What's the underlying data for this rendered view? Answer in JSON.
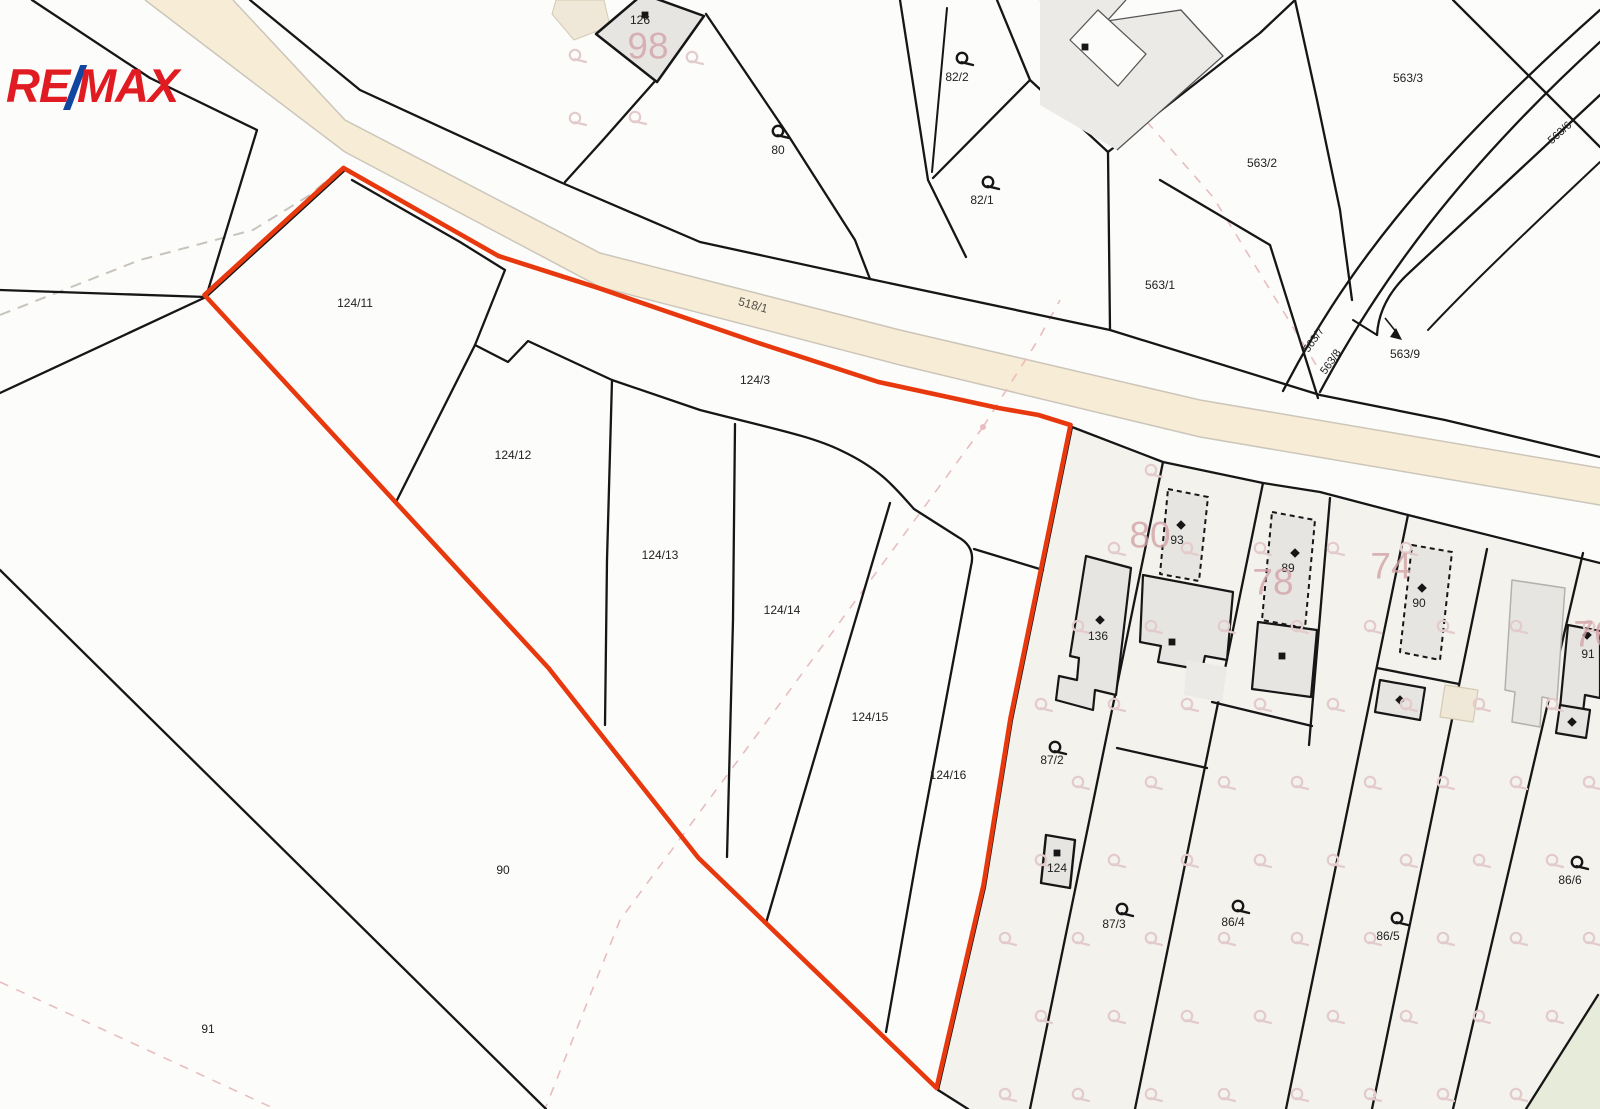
{
  "logo": {
    "re": "RE",
    "slash": "/",
    "max": "MAX"
  },
  "colors": {
    "bg": "#fcfcfb",
    "line": "#161616",
    "red": "#e8380d",
    "red_dark": "#c42d08",
    "road_fill": "#f7ecd6",
    "road_edge": "#ccc6ba",
    "ivory": "#f3f2ec",
    "green": "#e6ecd9",
    "building": "#e7e5e2",
    "building_lt": "#eceae6",
    "tan": "#efe8d9",
    "tan_edge": "#d5cab1",
    "gray_edge": "#b3b1ac",
    "label": "#222222",
    "road_label": "#55504a",
    "pink_label": "#d2a3a6",
    "pink_line": "#e9bdbd",
    "pink_sym": "#e3cbcb",
    "gray_dash": "#c9c4bb",
    "thin_edge": "#555555"
  },
  "map": {
    "road": {
      "fill": "M233,0 L345,120 L600,253 L900,330 L1200,400 L1600,468 L1600,505 L1200,437 L900,365 L600,287 L345,152 L250,80 L145,0 Z",
      "edges": [
        "M233,0 L345,120 L600,253 L900,330 L1200,400 L1600,468",
        "M145,0 L250,80 L345,152 L600,287 L900,365 L1200,437 L1600,505"
      ]
    },
    "regions": [
      {
        "d": "M1072,427 L1163,462 L1263,483 L1320,492 L1400,513 L1600,563 L1600,1109 L968,1109 L938,1090 L985,887 L1012,720 Z",
        "fill": "ivory"
      },
      {
        "d": "M1598,995 L1600,993 L1600,1109 L1526,1109 Z",
        "fill": "green"
      }
    ],
    "gray_dashed": [
      "M0,315 L140,260 L253,230 L310,195 L345,165"
    ],
    "pink_dashed": [
      "M983,427 L1038,340 L1060,300",
      "M983,427 L790,690 L620,920 L545,1109",
      "M0,982 L273,1108",
      "M1040,0 L1213,197 L1318,368"
    ],
    "pink_dot": [
      983,
      427
    ],
    "lines": [
      {
        "d": "M32,0 L150,78 L257,130 L206,297"
      },
      {
        "d": "M0,290 L206,297"
      },
      {
        "d": "M206,297 L0,393"
      },
      {
        "d": "M250,0 L360,90 L560,182 L700,242 L870,279 L1110,330 L1320,395 L1445,420 L1600,457"
      },
      {
        "d": "M656,80 L603,140 L565,182"
      },
      {
        "d": "M706,14 L788,135 L855,240 L870,279"
      },
      {
        "d": "M900,0 L928,180 L966,257"
      },
      {
        "d": "M947,8 L932,172",
        "w": 2
      },
      {
        "d": "M997,0 L1030,80 L933,178"
      },
      {
        "d": "M1030,80 L1108,152 L1110,330"
      },
      {
        "d": "M1108,152 L1260,33 L1295,0"
      },
      {
        "d": "M1295,0 L1317,100 L1340,210 L1352,300"
      },
      {
        "d": "M1160,180 L1270,245 L1318,398"
      },
      {
        "d": "M1453,0 L1600,147"
      },
      {
        "d": "M1283,391 C1340,280 1420,170 1600,10"
      },
      {
        "d": "M1320,392 C1380,280 1460,170 1600,42"
      },
      {
        "d": "M1377,335 Q1379,300 1410,272 C1460,225 1530,160 1600,95"
      },
      {
        "d": "M1600,162 C1530,228 1470,285 1428,330",
        "w": 2
      },
      {
        "d": "M1353,320 L1377,335",
        "w": 2
      },
      {
        "d": "M1072,427 L1163,462 L1263,483 L1320,492 L1400,513 L1600,563"
      },
      {
        "d": "M352,180 L460,242 L505,270 L475,345 L396,502"
      },
      {
        "d": "M475,345 L508,362 L528,341 L612,380 L700,410 C770,428 812,436 842,451 C882,470 896,489 914,509 L958,537 Q976,547 971,566 L918,850 L886,1032"
      },
      {
        "d": "M974,549 L1043,570"
      },
      {
        "d": "M612,380 L607,560 L605,725"
      },
      {
        "d": "M735,424 L733,620 L727,857"
      },
      {
        "d": "M890,503 L800,807 L766,923"
      },
      {
        "d": "M1163,462 L1030,1109"
      },
      {
        "d": "M1263,483 L1135,1109"
      },
      {
        "d": "M1330,498 L1309,745"
      },
      {
        "d": "M1408,515 L1286,1109"
      },
      {
        "d": "M1487,549 L1372,1109"
      },
      {
        "d": "M1583,553 L1453,1109"
      },
      {
        "d": "M1117,748 L1207,768"
      },
      {
        "d": "M1212,702 L1312,726"
      },
      {
        "d": "M1377,668 L1459,684"
      },
      {
        "d": "M1598,995 L1526,1109"
      },
      {
        "d": "M938,1090 L968,1109"
      },
      {
        "d": "M0,570 L546,1109"
      }
    ],
    "red_underlay": [
      "M206,297 L345,170",
      "M206,297 L550,670 L700,860 L938,1090",
      "M938,1090 L985,887 L1012,720 L1072,427"
    ],
    "red_outline": "M206,297 L345,170 L500,258 L600,290 L760,345 L880,384 L1000,410 L1040,417 L1072,427 L1012,720 L985,887 L938,1090 L700,860 L550,670 Z",
    "buildings": [
      {
        "pts": "556,0 604,0 610,26 574,40 552,14",
        "fill": "tan",
        "stroke": "tan_edge",
        "w": 1
      },
      {
        "pts": "1040,0 1126,0 1107,21 1181,10 1223,56 1117,150 1040,105",
        "fill": "building_lt",
        "stroke": "none",
        "w": 0
      },
      {
        "pts": "596,34 643,-6 704,16 657,82",
        "fill": "building",
        "stroke": "line",
        "w": 2.5
      },
      {
        "pts": "1086,556 1131,568 1116,695 1095,690 1093,710 1056,700 1059,676 1077,680 1079,658 1070,656",
        "fill": "building",
        "stroke": "line",
        "w": 2.2
      },
      {
        "pts": "1168,489 1208,497 1199,581 1160,574",
        "fill": "building",
        "stroke": "line",
        "w": 2,
        "dash": "5,4"
      },
      {
        "pts": "1143,575 1233,592 1227,660 1205,656 1202,670 1158,662 1161,646 1140,642",
        "fill": "building",
        "stroke": "line",
        "w": 2.2
      },
      {
        "pts": "1187,660 1227,667 1222,702 1184,695",
        "fill": "building_lt",
        "stroke": "none",
        "w": 0
      },
      {
        "pts": "1272,512 1315,520 1305,628 1262,620",
        "fill": "building",
        "stroke": "line",
        "w": 2,
        "dash": "5,4"
      },
      {
        "pts": "1258,622 1317,630 1311,697 1252,689",
        "fill": "building",
        "stroke": "line",
        "w": 2.2
      },
      {
        "pts": "1412,545 1452,552 1440,660 1400,652",
        "fill": "building",
        "stroke": "line",
        "w": 2,
        "dash": "5,4"
      },
      {
        "pts": "1380,680 1425,688 1420,720 1375,712",
        "fill": "building",
        "stroke": "line",
        "w": 2.2
      },
      {
        "pts": "1445,685 1478,690 1473,722 1440,717",
        "fill": "tan",
        "stroke": "tan_edge",
        "w": 1.2
      },
      {
        "pts": "1512,580 1565,588 1557,700 1542,697 1540,727 1512,722 1515,692 1505,690",
        "fill": "building",
        "stroke": "gray_edge",
        "w": 1.5
      },
      {
        "pts": "1568,625 1600,631 1600,698 1585,695 1583,712 1560,708",
        "fill": "building",
        "stroke": "line",
        "w": 2.2
      },
      {
        "pts": "1560,705 1590,710 1586,738 1556,733",
        "fill": "building",
        "stroke": "line",
        "w": 2.2
      },
      {
        "pts": "1046,835 1075,840 1070,888 1041,883",
        "fill": "building",
        "stroke": "line",
        "w": 2.4
      }
    ],
    "thin_outlines": [
      {
        "d": "M1126,0 L1107,21 L1181,10 L1223,56 L1117,150",
        "stroke": "thin_edge",
        "w": 1.3
      },
      {
        "d": "M1098,10 L1146,54 L1118,86 L1070,40 Z",
        "stroke": "thin_edge",
        "w": 1.2,
        "fill": "#fcfcfb"
      }
    ],
    "marks": {
      "squares": [
        [
          645,
          15
        ],
        [
          1085,
          47
        ],
        [
          1172,
          642
        ],
        [
          1282,
          656
        ],
        [
          1057,
          853
        ]
      ],
      "diamonds": [
        [
          1100,
          620
        ],
        [
          1181,
          525
        ],
        [
          1295,
          553
        ],
        [
          1422,
          588
        ],
        [
          1400,
          700
        ],
        [
          1587,
          635
        ],
        [
          1572,
          722
        ]
      ]
    },
    "q_symbols": {
      "black": [
        [
          778,
          131
        ],
        [
          962,
          58
        ],
        [
          988,
          182
        ],
        [
          1055,
          747
        ],
        [
          1122,
          909
        ],
        [
          1238,
          906
        ],
        [
          1397,
          918
        ],
        [
          1577,
          862
        ]
      ],
      "pink_fixed": [
        [
          575,
          55
        ],
        [
          692,
          57
        ],
        [
          575,
          118
        ],
        [
          635,
          117
        ]
      ],
      "pink_grid": {
        "x0": 1005,
        "dx": 73,
        "y0": 470,
        "dy": 78,
        "cols": 9,
        "rows": 9,
        "stagger": 36
      }
    },
    "labels": {
      "parcels": [
        {
          "text": "126",
          "x": 640,
          "y": 20
        },
        {
          "text": "80",
          "x": 778,
          "y": 150
        },
        {
          "text": "82/2",
          "x": 957,
          "y": 77
        },
        {
          "text": "82/1",
          "x": 982,
          "y": 200
        },
        {
          "text": "563/2",
          "x": 1262,
          "y": 163
        },
        {
          "text": "563/3",
          "x": 1408,
          "y": 78
        },
        {
          "text": "563/1",
          "x": 1160,
          "y": 285
        },
        {
          "text": "563/6",
          "x": 1560,
          "y": 133,
          "rot": -42
        },
        {
          "text": "563/7",
          "x": 1314,
          "y": 340,
          "rot": -55
        },
        {
          "text": "563/8",
          "x": 1331,
          "y": 362,
          "rot": -55
        },
        {
          "text": "563/9",
          "x": 1405,
          "y": 354
        },
        {
          "text": "124/3",
          "x": 755,
          "y": 380
        },
        {
          "text": "124/11",
          "x": 355,
          "y": 303
        },
        {
          "text": "124/12",
          "x": 513,
          "y": 455
        },
        {
          "text": "124/13",
          "x": 660,
          "y": 555
        },
        {
          "text": "124/14",
          "x": 782,
          "y": 610
        },
        {
          "text": "124/15",
          "x": 870,
          "y": 717
        },
        {
          "text": "124/16",
          "x": 948,
          "y": 775
        },
        {
          "text": "90",
          "x": 503,
          "y": 870
        },
        {
          "text": "91",
          "x": 208,
          "y": 1029
        },
        {
          "text": "136",
          "x": 1098,
          "y": 636
        },
        {
          "text": "93",
          "x": 1177,
          "y": 540
        },
        {
          "text": "89",
          "x": 1288,
          "y": 568
        },
        {
          "text": "90",
          "x": 1419,
          "y": 603
        },
        {
          "text": "91",
          "x": 1588,
          "y": 654
        },
        {
          "text": "124",
          "x": 1057,
          "y": 868
        },
        {
          "text": "87/2",
          "x": 1052,
          "y": 760
        },
        {
          "text": "87/3",
          "x": 1114,
          "y": 924
        },
        {
          "text": "86/4",
          "x": 1233,
          "y": 922
        },
        {
          "text": "86/5",
          "x": 1388,
          "y": 936
        },
        {
          "text": "86/6",
          "x": 1570,
          "y": 880
        }
      ],
      "road": {
        "text": "518/1",
        "x": 753,
        "y": 305,
        "rot": 15.5
      },
      "pink": [
        {
          "text": "98",
          "x": 648,
          "y": 46
        },
        {
          "text": "80",
          "x": 1150,
          "y": 535
        },
        {
          "text": "78",
          "x": 1273,
          "y": 582
        },
        {
          "text": "74",
          "x": 1391,
          "y": 566
        },
        {
          "text": "76",
          "x": 1594,
          "y": 634
        }
      ]
    },
    "arrow": {
      "line": "M1385,318 L1397,333",
      "head": "1402,340 1390,337 1396,328"
    }
  }
}
